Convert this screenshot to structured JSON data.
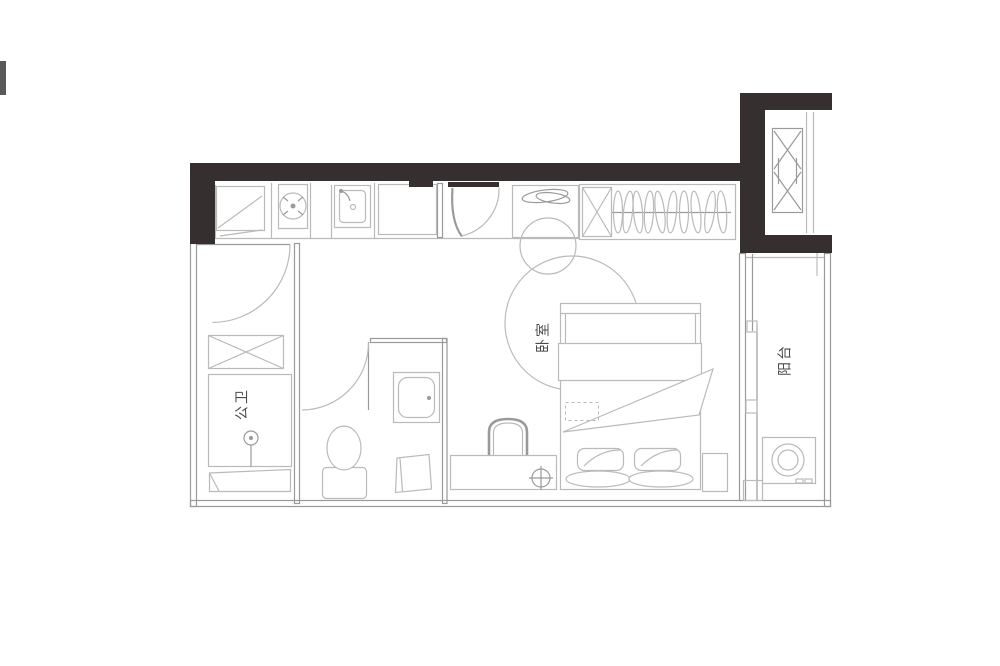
{
  "colors": {
    "wall": "#362f2f",
    "line": "#bababa",
    "line_dark": "#9a9a9a",
    "label": "#4b4b4b",
    "bg": "#ffffff",
    "edge_mark": "#3c3c3c"
  },
  "floorplan": {
    "title": "studio-apartment-floor-plan",
    "rooms": [
      {
        "id": "bathroom",
        "label": "公卫"
      },
      {
        "id": "bedroom",
        "label": "卧室"
      },
      {
        "id": "balcony",
        "label": "阳台"
      }
    ],
    "fixtures": [
      "fridge-icon",
      "cooktop-icon",
      "kitchen-sink-icon",
      "entry-door-icon",
      "plant-icon",
      "wardrobe-icon",
      "elevator-icon",
      "bathroom-door-icon",
      "shower-icon",
      "shower-bench-icon",
      "wet-room-door-icon",
      "toilet-icon",
      "washbasin-icon",
      "bath-mat-icon",
      "round-rug-icon",
      "stool-icon",
      "double-bed-icon",
      "nightstand-icon",
      "dresser-bench-icon",
      "arch-mirror-icon",
      "floor-drain-icon",
      "sliding-door-icon",
      "washing-machine-icon"
    ]
  }
}
